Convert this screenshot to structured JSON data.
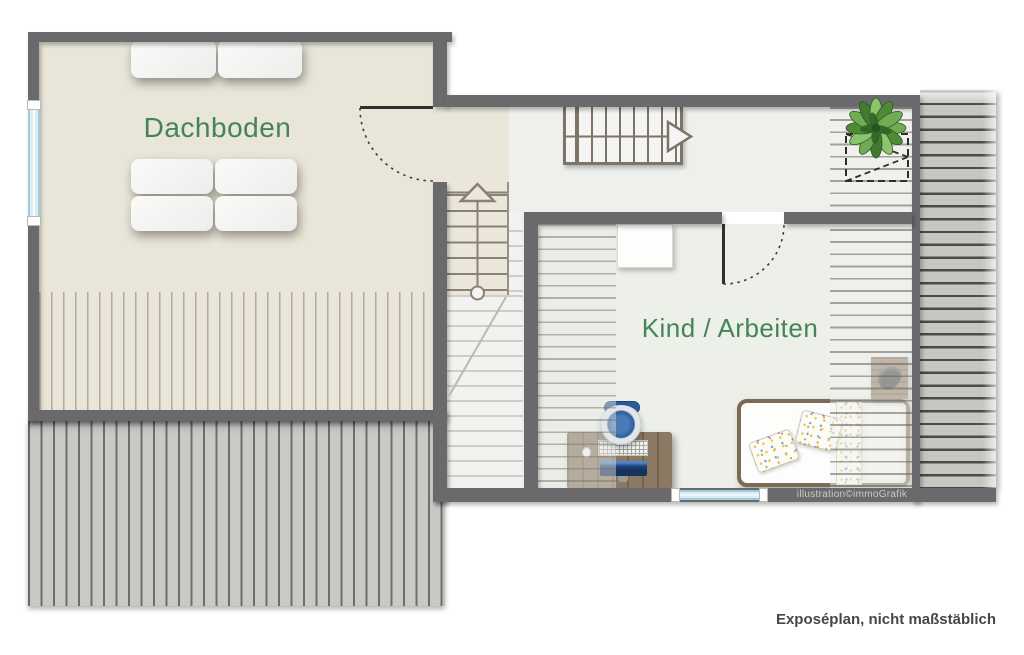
{
  "page": {
    "caption": "Exposéplan, nicht maßstäblich",
    "watermark": "illustration©immoGrafik"
  },
  "rooms": {
    "attic": {
      "label": "Dachboden"
    },
    "child_work": {
      "label": "Kind / Arbeiten"
    }
  },
  "icons": {
    "plant": "plant-top-view",
    "stairs_up": "stairs-arrow-up",
    "stairs_right": "stairs-arrow-right",
    "skylight": "dashed-roof-window",
    "door_swing": "dotted-quarter-arc"
  },
  "colors": {
    "page_bg": "#ffffff",
    "wall": "#6a696b",
    "room_label": "#458457",
    "floor_attic": "#e9e5d8",
    "floor_hall": "#eff0ec",
    "floor_room": "#edefe9",
    "floor_stairwell": "#f2f2f0",
    "roof_area_grey": "#c9c9c6",
    "window_glass": "#dcedf4",
    "stair_outline": "#7d7468",
    "desk_wood": "#8c7963",
    "bed_frame": "#7b6a55",
    "chair_blue": "#2b5d9b",
    "plant_green": "#4e8a38",
    "caption_text": "#474747",
    "watermark_text": "#cccbc9"
  }
}
